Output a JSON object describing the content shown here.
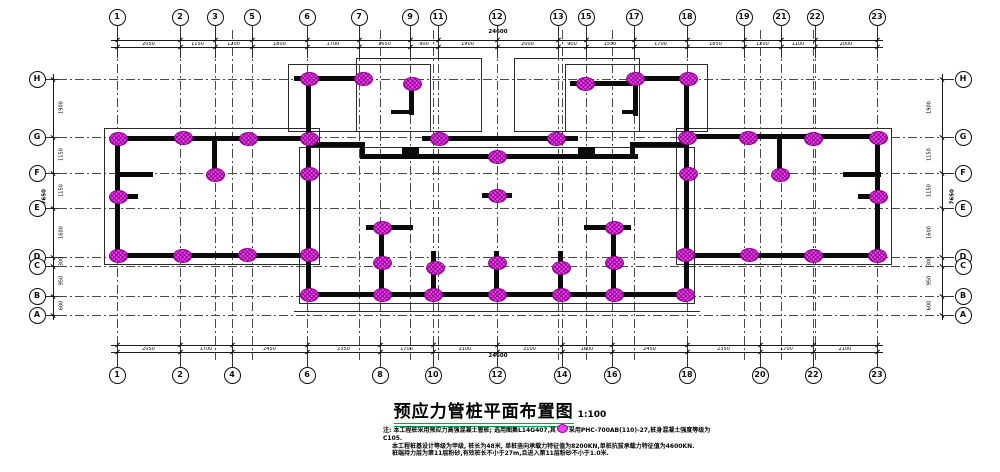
{
  "title": {
    "text": "预应力管桩平面布置图",
    "scale": "1:100"
  },
  "notes": {
    "line1_pre": "注: 本工程桩采用预应力高强混凝土管桩; 选用图集L14G407,其",
    "line1_post": "采用PHC-700AB(110)-27,桩身混凝土强度等级为C105.",
    "line2": "本工程桩基设计等级为甲级, 桩长为48米, 单桩竖向承载力特征值为8200KN,单桩抗拔承载力特征值为4600KN.",
    "line3": "桩端持力层为第11层粉砂,有效桩长不小于27m,且进入第11层粉砂不小于1.0米."
  },
  "colors": {
    "pile_fill": "#f23ef2",
    "pile_hatch": "#8d008d",
    "wall": "#0a0a0a",
    "grid_line": "#4a4a4a",
    "title_underline": "#00a550"
  },
  "grid": {
    "top_bubbles": [
      [
        "1",
        117
      ],
      [
        "2",
        180
      ],
      [
        "3",
        215
      ],
      [
        "5",
        252
      ],
      [
        "6",
        307
      ],
      [
        "7",
        359
      ],
      [
        "9",
        410
      ],
      [
        "11",
        438
      ],
      [
        "12",
        497
      ],
      [
        "13",
        558
      ],
      [
        "15",
        586
      ],
      [
        "17",
        634
      ],
      [
        "18",
        687
      ],
      [
        "19",
        744
      ],
      [
        "21",
        781
      ],
      [
        "22",
        815
      ],
      [
        "23",
        877
      ]
    ],
    "bottom_bubbles": [
      [
        "1",
        117
      ],
      [
        "2",
        180
      ],
      [
        "4",
        232
      ],
      [
        "6",
        307
      ],
      [
        "8",
        380
      ],
      [
        "10",
        433
      ],
      [
        "12",
        497
      ],
      [
        "14",
        562
      ],
      [
        "16",
        612
      ],
      [
        "18",
        687
      ],
      [
        "20",
        760
      ],
      [
        "22",
        813
      ],
      [
        "23",
        877
      ]
    ],
    "side_bubbles": [
      [
        "H",
        79
      ],
      [
        "G",
        137
      ],
      [
        "F",
        173
      ],
      [
        "E",
        208
      ],
      [
        "D",
        257
      ],
      [
        "C",
        266
      ],
      [
        "B",
        296
      ],
      [
        "A",
        315
      ]
    ]
  },
  "dimensions": {
    "top": {
      "ticks": [
        117,
        180,
        215,
        252,
        307,
        359,
        410,
        438,
        497,
        558,
        586,
        634,
        687,
        744,
        781,
        815,
        877
      ],
      "values": [
        "2050",
        "1150",
        "1200",
        "1800",
        "1700",
        "1650",
        "900",
        "1900",
        "2000",
        "900",
        "1550",
        "1700",
        "1850",
        "1200",
        "1100",
        "2000"
      ],
      "total": "24600"
    },
    "bottom": {
      "ticks": [
        117,
        180,
        232,
        307,
        380,
        433,
        497,
        562,
        612,
        687,
        760,
        813,
        877
      ],
      "values": [
        "2050",
        "1700",
        "2450",
        "2350",
        "1700",
        "2100",
        "2100",
        "1600",
        "2450",
        "2350",
        "1700",
        "2100"
      ],
      "total": "24600"
    },
    "side": {
      "ticks": [
        79,
        137,
        173,
        208,
        257,
        266,
        296,
        315
      ],
      "values": [
        "1900",
        "1150",
        "1150",
        "1600",
        "300",
        "950",
        "600"
      ],
      "total": "7650"
    }
  },
  "piles": [
    [
      309,
      79
    ],
    [
      363,
      79
    ],
    [
      412,
      84
    ],
    [
      585,
      84
    ],
    [
      635,
      79
    ],
    [
      688,
      79
    ],
    [
      118,
      139
    ],
    [
      183,
      138
    ],
    [
      248,
      139
    ],
    [
      309,
      139
    ],
    [
      439,
      139
    ],
    [
      556,
      139
    ],
    [
      687,
      138
    ],
    [
      748,
      138
    ],
    [
      813,
      139
    ],
    [
      878,
      138
    ],
    [
      497,
      157
    ],
    [
      215,
      175
    ],
    [
      309,
      174
    ],
    [
      688,
      174
    ],
    [
      780,
      175
    ],
    [
      382,
      228
    ],
    [
      614,
      228
    ],
    [
      118,
      197
    ],
    [
      497,
      196
    ],
    [
      878,
      197
    ],
    [
      118,
      256
    ],
    [
      182,
      256
    ],
    [
      247,
      255
    ],
    [
      309,
      255
    ],
    [
      685,
      255
    ],
    [
      749,
      255
    ],
    [
      813,
      256
    ],
    [
      877,
      256
    ],
    [
      382,
      263
    ],
    [
      435,
      268
    ],
    [
      497,
      263
    ],
    [
      561,
      268
    ],
    [
      614,
      263
    ],
    [
      309,
      295
    ],
    [
      382,
      295
    ],
    [
      433,
      295
    ],
    [
      497,
      295
    ],
    [
      561,
      295
    ],
    [
      614,
      295
    ],
    [
      685,
      295
    ]
  ],
  "walls": [
    [
      112,
      136,
      202,
      5
    ],
    [
      115,
      136,
      5,
      122
    ],
    [
      112,
      253,
      202,
      5
    ],
    [
      212,
      136,
      5,
      45
    ],
    [
      115,
      172,
      38,
      5
    ],
    [
      112,
      194,
      26,
      5
    ],
    [
      306,
      136,
      5,
      161
    ],
    [
      294,
      76,
      78,
      5
    ],
    [
      306,
      76,
      5,
      60
    ],
    [
      409,
      81,
      5,
      34
    ],
    [
      391,
      110,
      19,
      4
    ],
    [
      306,
      142,
      58,
      5
    ],
    [
      360,
      142,
      5,
      17
    ],
    [
      360,
      154,
      278,
      5
    ],
    [
      422,
      136,
      156,
      5
    ],
    [
      630,
      142,
      58,
      5
    ],
    [
      630,
      142,
      5,
      17
    ],
    [
      630,
      76,
      60,
      5
    ],
    [
      633,
      76,
      5,
      40
    ],
    [
      570,
      81,
      63,
      5
    ],
    [
      622,
      110,
      16,
      4
    ],
    [
      684,
      76,
      5,
      221
    ],
    [
      684,
      134,
      198,
      5
    ],
    [
      875,
      134,
      5,
      124
    ],
    [
      682,
      253,
      200,
      5
    ],
    [
      777,
      134,
      5,
      46
    ],
    [
      843,
      172,
      38,
      5
    ],
    [
      858,
      194,
      26,
      5
    ],
    [
      402,
      147,
      17,
      11
    ],
    [
      578,
      147,
      17,
      11
    ],
    [
      366,
      225,
      47,
      5
    ],
    [
      584,
      225,
      47,
      5
    ],
    [
      379,
      228,
      5,
      69
    ],
    [
      431,
      251,
      5,
      46
    ],
    [
      494,
      251,
      5,
      46
    ],
    [
      482,
      193,
      30,
      5
    ],
    [
      558,
      251,
      5,
      46
    ],
    [
      611,
      228,
      5,
      69
    ],
    [
      306,
      292,
      385,
      5
    ]
  ],
  "outlines": [
    [
      104,
      128,
      216,
      137
    ],
    [
      676,
      128,
      216,
      137
    ],
    [
      288,
      64,
      143,
      68
    ],
    [
      565,
      64,
      143,
      68
    ],
    [
      356,
      58,
      126,
      74
    ],
    [
      514,
      58,
      126,
      74
    ],
    [
      299,
      147,
      396,
      157
    ],
    [
      294,
      311,
      406,
      1
    ]
  ]
}
